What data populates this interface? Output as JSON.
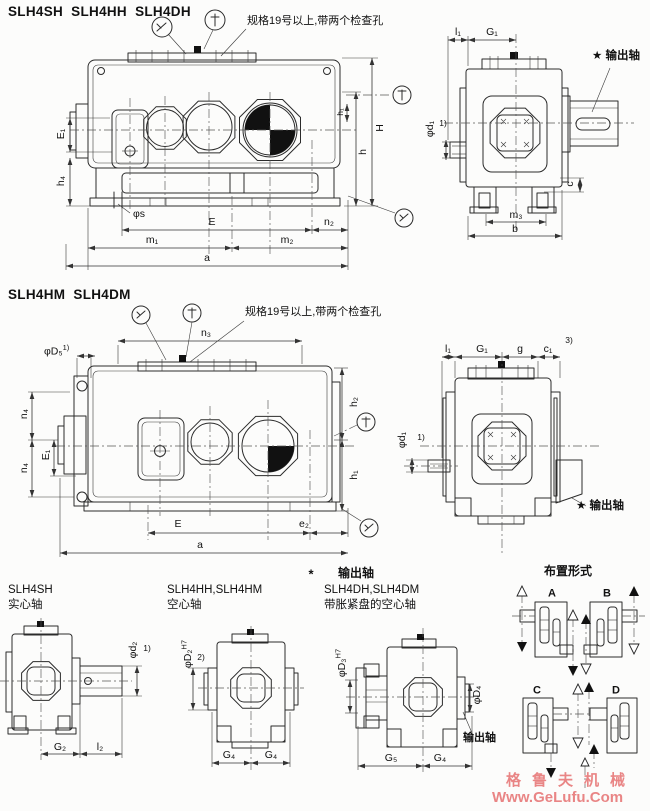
{
  "top": {
    "title": "SLH4SH  SLH4HH  SLH4DH",
    "note": "规格19号以上,带两个检查孔",
    "side": {
      "E1": "E₁",
      "h4": "h₄",
      "phi_s": "φs",
      "E": "E",
      "n2": "n₂",
      "m1": "m₁",
      "m2": "m₂",
      "a": "a",
      "H": "H",
      "h": "h",
      "h1": "h₁"
    },
    "front": {
      "l1": "l₁",
      "G1": "G₁",
      "output": "★ 输出轴",
      "phi_d1": "φd₁",
      "fn1": "1)",
      "c": "c",
      "m3": "m₃",
      "b": "b"
    }
  },
  "mid": {
    "title": "SLH4HM  SLH4DM",
    "note": "规格19号以上,带两个检查孔",
    "side": {
      "phi_D5": "φD₅",
      "fn1": "1)",
      "n3": "n₃",
      "n4_top": "n₄",
      "E1": "E₁",
      "n4_bottom": "n₄",
      "E": "E",
      "e2": "e₂",
      "a": "a",
      "h2": "h₂",
      "h1": "h₁"
    },
    "front": {
      "l1": "l₁",
      "G1": "G₁",
      "g": "g",
      "c1": "c₁",
      "fn3": "3)",
      "phi_d1": "φd₁",
      "fn1": "1)",
      "output": "★ 输出轴"
    }
  },
  "bottom": {
    "star": "*",
    "star_label": "输出轴",
    "col1": {
      "name": "SLH4SH",
      "type": "实心轴",
      "phi_d2": "φd₂",
      "fn1": "1)",
      "G2": "G₂",
      "l2": "l₂"
    },
    "col2": {
      "name": "SLH4HH,SLH4HM",
      "type": "空心轴",
      "phi_D2": "φD₂",
      "tol": "H7",
      "fn2": "2)",
      "G4_left": "G₄",
      "G4_right": "G₄"
    },
    "col3": {
      "name": "SLH4DH,SLH4DM",
      "type": "带胀紧盘的空心轴",
      "phi_D3": "φD₃",
      "tol": "H7",
      "phi_D4": "φD₄",
      "output": "输出轴",
      "G5": "G₅",
      "G4": "G₄"
    },
    "arrangement": {
      "header": "布置形式",
      "a": "A",
      "b": "B",
      "c": "C",
      "d": "D"
    }
  },
  "watermark": {
    "line1": "格鲁夫机械",
    "line2": "Www.GeLufu.Com",
    "color": "#e98585"
  }
}
